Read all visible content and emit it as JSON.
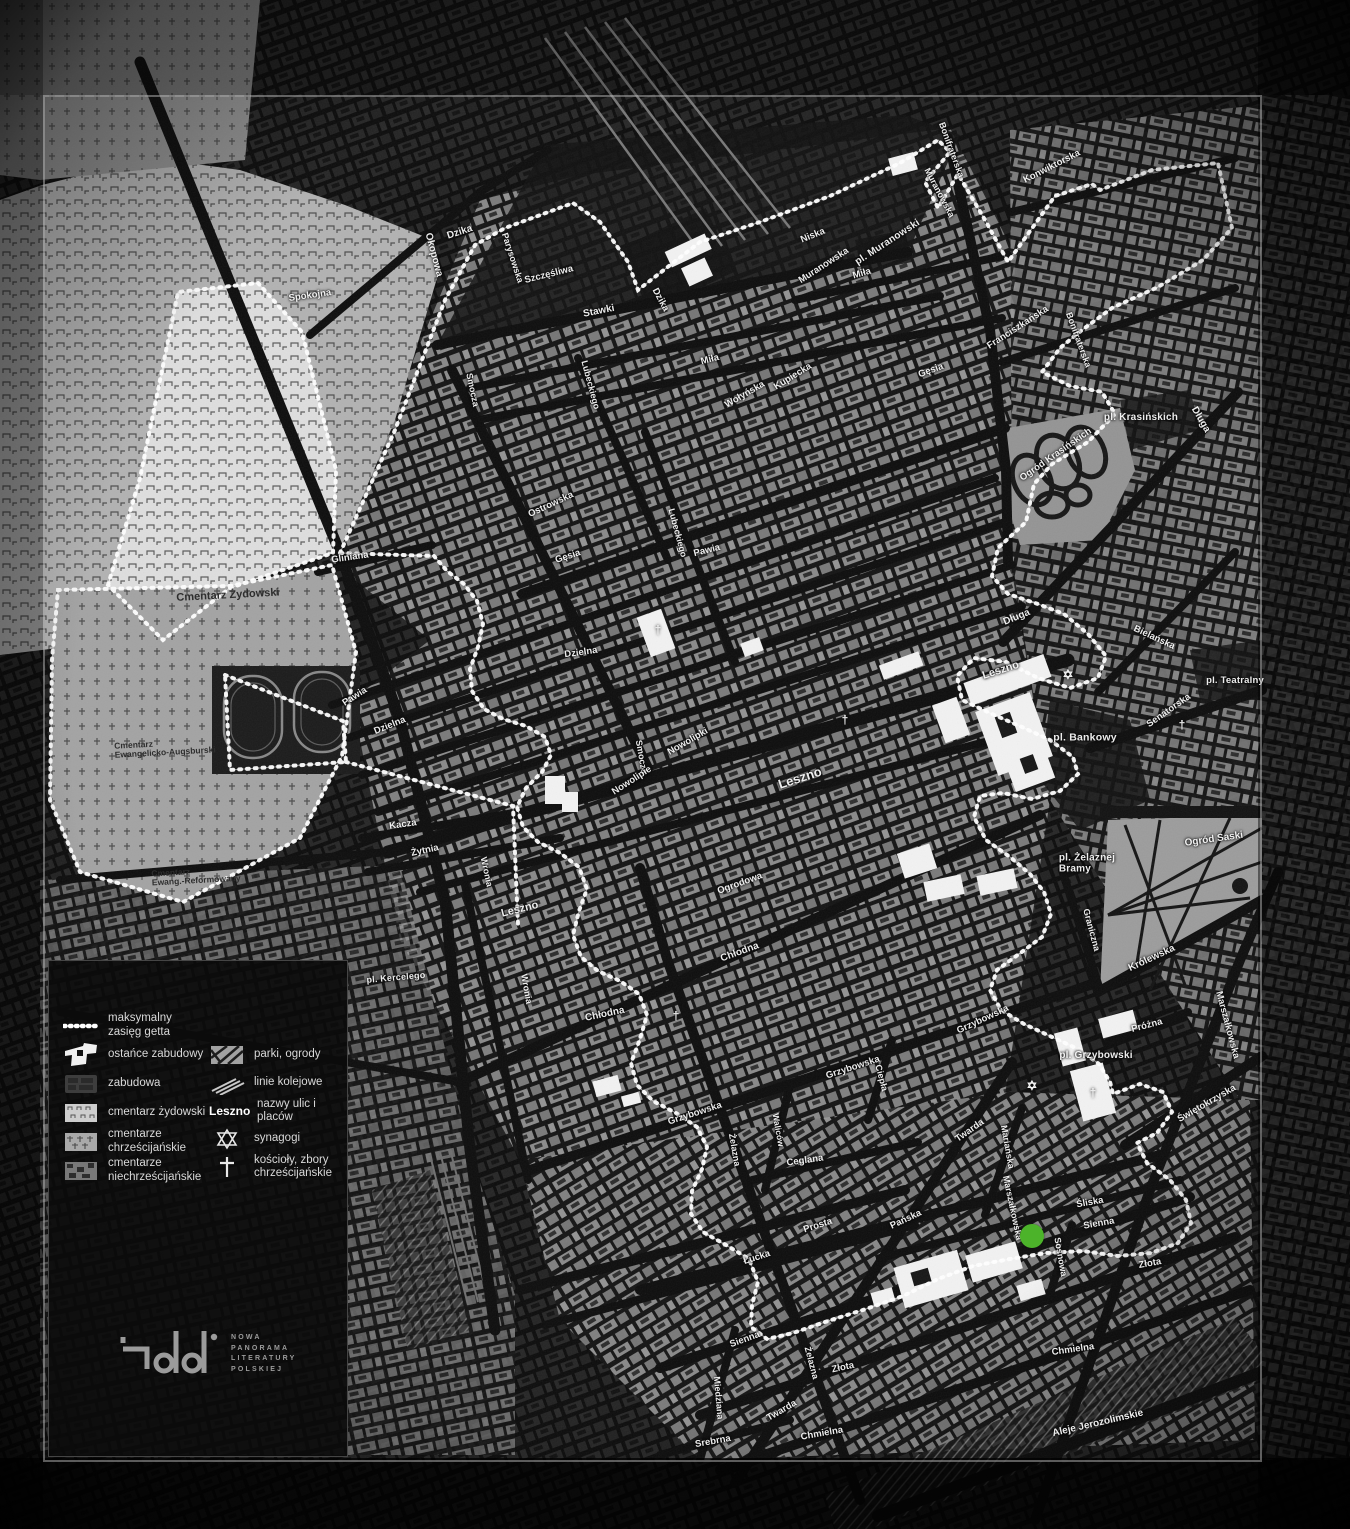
{
  "map": {
    "marker": {
      "x": 1032,
      "y": 1236,
      "radius": 12,
      "color": "#4cb32a"
    },
    "colors": {
      "boundary": "#ffffff",
      "frame": "#a5a5a5",
      "background": "#0a0a0a"
    },
    "glyphs": {
      "synagogue": "✡",
      "church": "†"
    },
    "synagogues": [
      {
        "x": 1068,
        "y": 675
      },
      {
        "x": 1032,
        "y": 1086
      }
    ],
    "churches": [
      {
        "x": 658,
        "y": 630
      },
      {
        "x": 845,
        "y": 720
      },
      {
        "x": 1182,
        "y": 725
      },
      {
        "x": 1093,
        "y": 1093
      },
      {
        "x": 676,
        "y": 1016
      }
    ],
    "labels": [
      [
        "Okopowa",
        433,
        255,
        75,
        10,
        ""
      ],
      [
        "Dzika",
        460,
        233,
        -18,
        10,
        ""
      ],
      [
        "Spokojna",
        310,
        296,
        -8,
        9.5,
        ""
      ],
      [
        "Parysowska",
        512,
        258,
        72,
        9,
        ""
      ],
      [
        "Szczęśliwa",
        549,
        275,
        -14,
        9.5,
        ""
      ],
      [
        "Stawki",
        599,
        312,
        -11,
        10,
        ""
      ],
      [
        "Dzika",
        660,
        300,
        62,
        9.5,
        ""
      ],
      [
        "Miła",
        710,
        360,
        -14,
        9.5,
        ""
      ],
      [
        "Niska",
        813,
        236,
        -22,
        9.5,
        ""
      ],
      [
        "Muranowska",
        824,
        266,
        -33,
        9.5,
        ""
      ],
      [
        "pl. Muranowski",
        888,
        243,
        -33,
        10,
        "b"
      ],
      [
        "Muranowska",
        939,
        193,
        62,
        9,
        ""
      ],
      [
        "Miła",
        862,
        274,
        -16,
        9.5,
        ""
      ],
      [
        "Konwiktorska",
        1052,
        167,
        -27,
        9.5,
        ""
      ],
      [
        "Bonifraterska",
        951,
        150,
        70,
        9,
        ""
      ],
      [
        "Bonifraterska",
        1078,
        340,
        70,
        9,
        ""
      ],
      [
        "Franciszkańska",
        1018,
        328,
        -33,
        9.5,
        ""
      ],
      [
        "Kupiecka",
        793,
        377,
        -32,
        9.5,
        ""
      ],
      [
        "Wołyńska",
        745,
        395,
        -30,
        9.5,
        ""
      ],
      [
        "Lubeckiego",
        590,
        385,
        75,
        9,
        ""
      ],
      [
        "Lubeckiego",
        677,
        533,
        75,
        9,
        ""
      ],
      [
        "Ostrowska",
        551,
        505,
        -25,
        9.5,
        ""
      ],
      [
        "Gęsia",
        568,
        557,
        -18,
        9.5,
        ""
      ],
      [
        "Gęsia",
        931,
        371,
        -20,
        9.5,
        ""
      ],
      [
        "Pawia",
        707,
        551,
        -14,
        9.5,
        ""
      ],
      [
        "Pawia",
        355,
        697,
        -33,
        9.5,
        ""
      ],
      [
        "Gliniana",
        350,
        558,
        -8,
        9.5,
        ""
      ],
      [
        "Dzielna",
        581,
        653,
        -8,
        9.5,
        ""
      ],
      [
        "Dzielna",
        390,
        726,
        -22,
        9.5,
        ""
      ],
      [
        "Smocza",
        472,
        390,
        78,
        9,
        ""
      ],
      [
        "Smocza",
        641,
        757,
        80,
        9,
        ""
      ],
      [
        "Nowolipie",
        632,
        781,
        -33,
        9.5,
        ""
      ],
      [
        "Nowolipki",
        688,
        742,
        -30,
        9.5,
        ""
      ],
      [
        "Leszno",
        800,
        778,
        -18,
        13,
        ""
      ],
      [
        "Leszno",
        1001,
        671,
        -18,
        11,
        ""
      ],
      [
        "Leszno",
        520,
        910,
        -14,
        11,
        ""
      ],
      [
        "Kacza",
        403,
        825,
        -8,
        9.5,
        ""
      ],
      [
        "Żytnia",
        425,
        851,
        -12,
        9.5,
        ""
      ],
      [
        "Wronia",
        486,
        872,
        78,
        9,
        ""
      ],
      [
        "Wronia",
        526,
        989,
        80,
        9,
        ""
      ],
      [
        "Ogrodowa",
        740,
        884,
        -20,
        9.5,
        ""
      ],
      [
        "Chłodna",
        605,
        1015,
        -12,
        10,
        ""
      ],
      [
        "Chłodna",
        740,
        953,
        -20,
        10,
        ""
      ],
      [
        "pl. Kercelego",
        396,
        978,
        -5,
        9,
        "b"
      ],
      [
        "Grzybowska",
        695,
        1114,
        -18,
        9.5,
        ""
      ],
      [
        "Grzybowska",
        853,
        1068,
        -18,
        9.5,
        ""
      ],
      [
        "Grzybowska",
        983,
        1020,
        -25,
        9.5,
        ""
      ],
      [
        "Ciepła",
        881,
        1078,
        75,
        9,
        ""
      ],
      [
        "Żelazna",
        734,
        1150,
        80,
        9,
        ""
      ],
      [
        "Żelazna",
        811,
        1363,
        75,
        9,
        ""
      ],
      [
        "Waliców",
        778,
        1130,
        80,
        8.5,
        ""
      ],
      [
        "Ceglana",
        805,
        1161,
        -8,
        9.5,
        ""
      ],
      [
        "Twarda",
        970,
        1131,
        -35,
        9.5,
        ""
      ],
      [
        "Twarda",
        782,
        1411,
        -30,
        9.5,
        ""
      ],
      [
        "Prosta",
        818,
        1226,
        -18,
        9.5,
        ""
      ],
      [
        "Łucka",
        757,
        1258,
        -18,
        9.5,
        ""
      ],
      [
        "Pańska",
        906,
        1220,
        -25,
        9.5,
        ""
      ],
      [
        "Mariańska",
        1007,
        1147,
        80,
        9,
        ""
      ],
      [
        "Marszałkowska",
        1012,
        1208,
        78,
        9,
        ""
      ],
      [
        "Marszałkowska",
        1227,
        1025,
        75,
        9.5,
        ""
      ],
      [
        "Śliska",
        1090,
        1203,
        -10,
        9.5,
        ""
      ],
      [
        "Sienna",
        1099,
        1224,
        -10,
        9.5,
        ""
      ],
      [
        "Sienna",
        745,
        1340,
        -20,
        9.5,
        ""
      ],
      [
        "Złota",
        1150,
        1264,
        -10,
        9.5,
        ""
      ],
      [
        "Złota",
        843,
        1368,
        -12,
        9.5,
        ""
      ],
      [
        "Sosnowa",
        1060,
        1257,
        80,
        9,
        ""
      ],
      [
        "Chmielna",
        1073,
        1350,
        -8,
        9.5,
        ""
      ],
      [
        "Chmielna",
        822,
        1434,
        -10,
        9.5,
        ""
      ],
      [
        "Srebrna",
        713,
        1442,
        -10,
        9.5,
        ""
      ],
      [
        "Miedziana",
        718,
        1398,
        85,
        9,
        ""
      ],
      [
        "Aleje Jerozolimskie",
        1098,
        1424,
        -13,
        10,
        ""
      ],
      [
        "Długa",
        1017,
        618,
        -22,
        10,
        ""
      ],
      [
        "Długa",
        1200,
        420,
        60,
        10,
        ""
      ],
      [
        "Bielańska",
        1154,
        638,
        25,
        9.5,
        ""
      ],
      [
        "Senatorska",
        1169,
        711,
        -35,
        9.5,
        ""
      ],
      [
        "pl. Krasińskich",
        1141,
        418,
        0,
        10,
        "b"
      ],
      [
        "Ogród Krasińskich",
        1056,
        455,
        -35,
        9.5,
        ""
      ],
      [
        "pl. Teatralny",
        1235,
        681,
        0,
        9.5,
        "b"
      ],
      [
        "pl. Bankowy",
        1085,
        738,
        0,
        10.5,
        "b"
      ],
      [
        "Ogród Saski",
        1214,
        840,
        -8,
        10,
        ""
      ],
      [
        "pl. Żelaznej\nBramy",
        1087,
        864,
        0,
        10,
        "b"
      ],
      [
        "Graniczna",
        1091,
        930,
        75,
        9,
        ""
      ],
      [
        "Królewska",
        1152,
        959,
        -25,
        10,
        ""
      ],
      [
        "Próżna",
        1147,
        1026,
        -15,
        9.5,
        ""
      ],
      [
        "pl. Grzybowski",
        1096,
        1056,
        0,
        10,
        "b"
      ],
      [
        "Świętokrzyska",
        1207,
        1104,
        -30,
        9.5,
        ""
      ],
      [
        "Cmentarz Żydowski",
        228,
        596,
        -3,
        11,
        "d"
      ],
      [
        "Cmentarz\nEwangelicko-Augsburski",
        165,
        748,
        -3,
        8.5,
        "d"
      ],
      [
        "Cmentarz\nEwang.-Reformowany",
        196,
        876,
        -3,
        8.5,
        "d"
      ]
    ]
  },
  "legend": {
    "columns": [
      [
        {
          "icon": "ghetto-extent",
          "label": "maksymalny zasięg getta"
        },
        {
          "icon": "remnant-buildings",
          "label": "ostańce zabudowy"
        },
        {
          "icon": "buildings",
          "label": "zabudowa"
        },
        {
          "icon": "jewish-cemetery",
          "label": "cmentarz żydowski"
        },
        {
          "icon": "christian-cemeteries",
          "label": "cmentarze chrześcijańskie"
        },
        {
          "icon": "non-christian-cemeteries",
          "label": "cmentarze niechrześcijańskie"
        }
      ],
      [
        {
          "icon": "parks",
          "label": "parki, ogrody"
        },
        {
          "icon": "railways",
          "label": "linie kolejowe"
        },
        {
          "icon": "street-name-sample",
          "sample": "Leszno",
          "label": "nazwy ulic i placów"
        },
        {
          "icon": "synagogue",
          "label": "synagogi"
        },
        {
          "icon": "church",
          "label": "kościoły, zbory chrześcijańskie"
        }
      ]
    ]
  },
  "logo": {
    "lines": [
      "NOWA",
      "PANORAMA",
      "LITERATURY",
      "POLSKIEJ"
    ]
  }
}
